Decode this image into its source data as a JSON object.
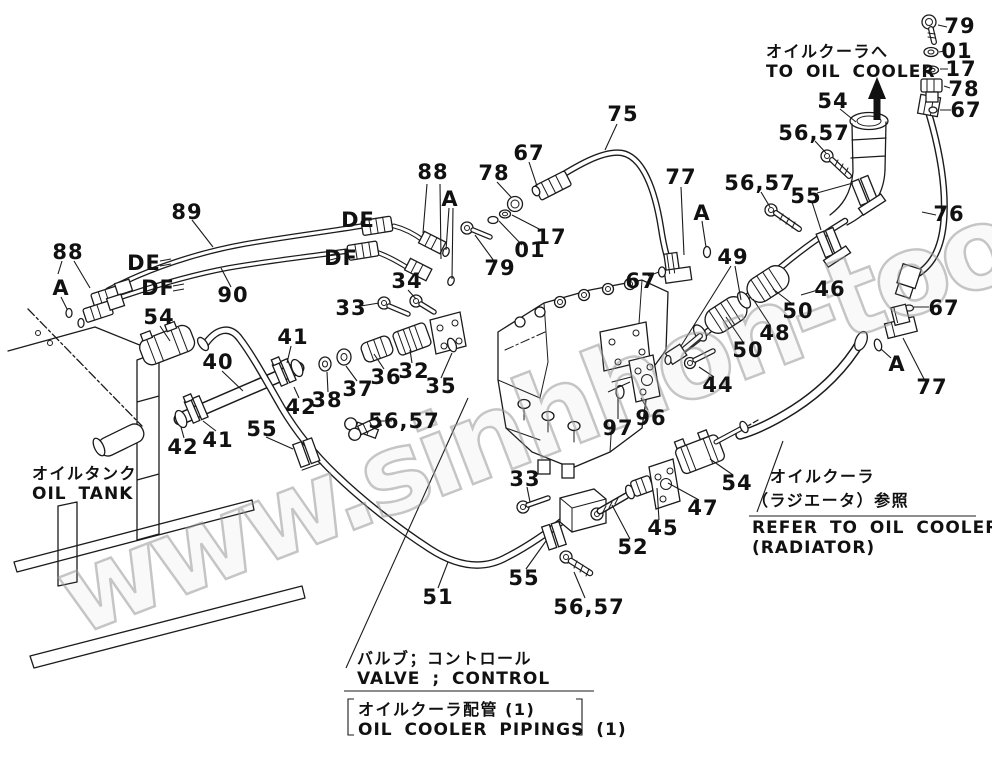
{
  "figure": {
    "watermark": "www.sinhhon-too.kz",
    "annotations": {
      "to_oil_cooler_jp": "オイルクーラへ",
      "to_oil_cooler_en": "TO OIL COOLER",
      "oil_tank_jp": "オイルタンク",
      "oil_tank_en": "OIL TANK",
      "refer_jp1": "オイルクーラ",
      "refer_jp2": "（ラジエータ）参照",
      "refer_en1": "REFER TO OIL COOLER",
      "refer_en2": "(RADIATOR)",
      "valve_jp": "バルブ；コントロール",
      "valve_en": "VALVE ; CONTROL",
      "pipings_jp": "オイルクーラ配管 (1)",
      "pipings_en": "OIL COOLER PIPINGS (1)"
    },
    "callouts": [
      {
        "text": "79",
        "x": 960,
        "y": 26
      },
      {
        "text": "01",
        "x": 957,
        "y": 51
      },
      {
        "text": "17",
        "x": 961,
        "y": 69
      },
      {
        "text": "78",
        "x": 964,
        "y": 89
      },
      {
        "text": "67",
        "x": 966,
        "y": 110
      },
      {
        "text": "54",
        "x": 833,
        "y": 101
      },
      {
        "text": "56,57",
        "x": 814,
        "y": 133
      },
      {
        "text": "56,57",
        "x": 760,
        "y": 183
      },
      {
        "text": "55",
        "x": 806,
        "y": 196
      },
      {
        "text": "76",
        "x": 949,
        "y": 214
      },
      {
        "text": "67",
        "x": 944,
        "y": 308
      },
      {
        "text": "75",
        "x": 623,
        "y": 114
      },
      {
        "text": "67",
        "x": 529,
        "y": 153
      },
      {
        "text": "78",
        "x": 494,
        "y": 173
      },
      {
        "text": "88",
        "x": 433,
        "y": 172
      },
      {
        "text": "A",
        "x": 450,
        "y": 199
      },
      {
        "text": "17",
        "x": 551,
        "y": 237
      },
      {
        "text": "01",
        "x": 530,
        "y": 250
      },
      {
        "text": "79",
        "x": 500,
        "y": 268
      },
      {
        "text": "77",
        "x": 681,
        "y": 177
      },
      {
        "text": "A",
        "x": 702,
        "y": 213
      },
      {
        "text": "67",
        "x": 641,
        "y": 281
      },
      {
        "text": "89",
        "x": 187,
        "y": 212
      },
      {
        "text": "88",
        "x": 68,
        "y": 252
      },
      {
        "text": "A",
        "x": 61,
        "y": 288
      },
      {
        "text": "DE",
        "x": 144,
        "y": 263
      },
      {
        "text": "DF",
        "x": 158,
        "y": 288
      },
      {
        "text": "90",
        "x": 233,
        "y": 295
      },
      {
        "text": "DE",
        "x": 358,
        "y": 220
      },
      {
        "text": "DF",
        "x": 341,
        "y": 258
      },
      {
        "text": "34",
        "x": 407,
        "y": 281
      },
      {
        "text": "33",
        "x": 351,
        "y": 308
      },
      {
        "text": "54",
        "x": 159,
        "y": 317
      },
      {
        "text": "41",
        "x": 293,
        "y": 337
      },
      {
        "text": "40",
        "x": 218,
        "y": 362
      },
      {
        "text": "42",
        "x": 301,
        "y": 407
      },
      {
        "text": "38",
        "x": 327,
        "y": 400
      },
      {
        "text": "37",
        "x": 358,
        "y": 389
      },
      {
        "text": "36",
        "x": 386,
        "y": 377
      },
      {
        "text": "32",
        "x": 414,
        "y": 371
      },
      {
        "text": "35",
        "x": 441,
        "y": 386
      },
      {
        "text": "56,57",
        "x": 404,
        "y": 421
      },
      {
        "text": "55",
        "x": 262,
        "y": 429
      },
      {
        "text": "41",
        "x": 218,
        "y": 440
      },
      {
        "text": "42",
        "x": 183,
        "y": 447
      },
      {
        "text": "49",
        "x": 733,
        "y": 257
      },
      {
        "text": "46",
        "x": 830,
        "y": 289
      },
      {
        "text": "50",
        "x": 798,
        "y": 311
      },
      {
        "text": "48",
        "x": 775,
        "y": 333
      },
      {
        "text": "50",
        "x": 748,
        "y": 350
      },
      {
        "text": "44",
        "x": 718,
        "y": 385
      },
      {
        "text": "96",
        "x": 651,
        "y": 418
      },
      {
        "text": "97",
        "x": 618,
        "y": 428
      },
      {
        "text": "A",
        "x": 897,
        "y": 364
      },
      {
        "text": "77",
        "x": 932,
        "y": 387
      },
      {
        "text": "33",
        "x": 525,
        "y": 479
      },
      {
        "text": "52",
        "x": 633,
        "y": 547
      },
      {
        "text": "45",
        "x": 663,
        "y": 528
      },
      {
        "text": "47",
        "x": 703,
        "y": 508
      },
      {
        "text": "54",
        "x": 737,
        "y": 483
      },
      {
        "text": "55",
        "x": 524,
        "y": 578
      },
      {
        "text": "56,57",
        "x": 589,
        "y": 607
      },
      {
        "text": "51",
        "x": 438,
        "y": 597
      }
    ]
  }
}
